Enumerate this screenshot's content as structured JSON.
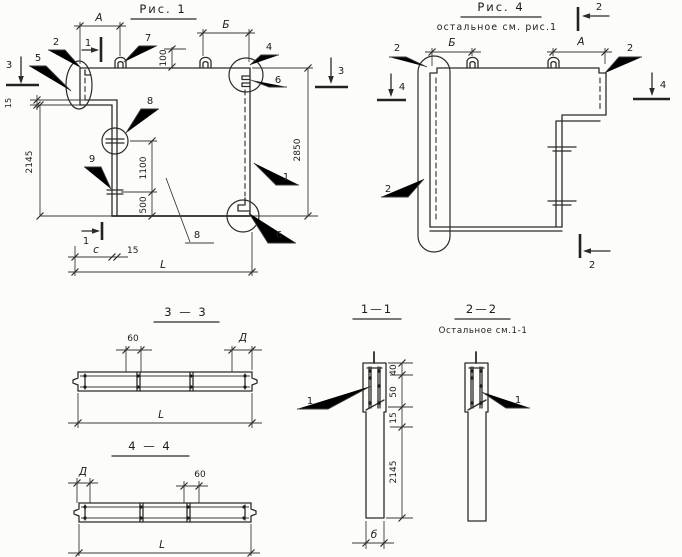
{
  "drawing": {
    "ink": "#2b2b2b",
    "paper": "#fcfcfa"
  },
  "fig1": {
    "title": "Рис. 1",
    "dims": {
      "A": "А",
      "B": "Б",
      "h100": "100",
      "v2850": "2850",
      "v2145": "2145",
      "v1100": "1100",
      "v500": "500",
      "left15": "15",
      "bottom15": "15",
      "c": "с",
      "L": "L"
    },
    "callouts": {
      "n1": "1",
      "n2": "2",
      "n4": "4",
      "n5": "5",
      "n6top": "6",
      "n6bot": "6",
      "n7": "7",
      "n8top": "8",
      "n8bot": "8",
      "n9": "9"
    },
    "markers": {
      "s1top": "1",
      "s1bot": "1",
      "s3left": "3",
      "s3right": "3"
    }
  },
  "fig4": {
    "title": "Рис. 4",
    "subtitle": "остальное  см. рис.1",
    "dims": {
      "A": "А",
      "B": "Б"
    },
    "callouts": {
      "tl": "2",
      "tr": "2",
      "left": "2"
    },
    "markers": {
      "s2top": "2",
      "s2bot": "2",
      "s4left": "4",
      "s4right": "4"
    }
  },
  "sec33": {
    "title": "3 — 3",
    "d60": "60",
    "dD": "Д",
    "L": "L"
  },
  "sec44": {
    "title": "4 — 4",
    "dD": "Д",
    "d60": "60",
    "L": "L"
  },
  "sec11": {
    "title": "1—1",
    "d40": "40",
    "d50": "50",
    "d15": "15",
    "d2145": "2145",
    "db": "б",
    "callout1": "1"
  },
  "sec22": {
    "title": "2—2",
    "subtitle": "Остальное см.1-1",
    "callout1": "1"
  }
}
